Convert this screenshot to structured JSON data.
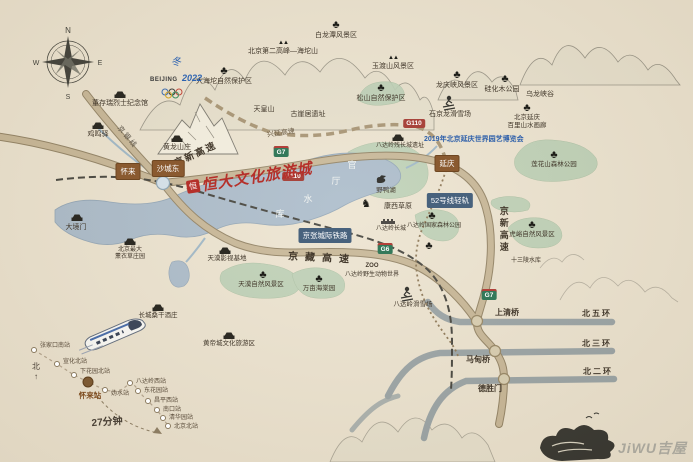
{
  "map": {
    "logo": {
      "seal": "恒",
      "text": "恒大文化旅游城"
    },
    "expo": "2019年北京延庆世界园艺博览会",
    "olympics": {
      "emblem": "冬",
      "name": "BEIJING",
      "year": "2022"
    },
    "compass": {
      "n": "N",
      "s": "S",
      "e": "E",
      "w": "W"
    },
    "trip_time": "27分钟",
    "north": "北",
    "north_arrow": "↑",
    "watermark": "JiWU吉屋",
    "colors": {
      "logo_red": "#b5302a",
      "expo_blue": "#2d5faa",
      "road_tan": "#c6b594",
      "ring_gray": "#97a1a3",
      "lake_blue": "#a9bac9",
      "green": "#b9ceb3",
      "town_brown": "#8a5a30"
    },
    "towns": [
      {
        "t": "怀来",
        "x": 128,
        "y": 163
      },
      {
        "t": "沙城东",
        "x": 168,
        "y": 160
      },
      {
        "t": "延庆",
        "x": 447,
        "y": 155
      }
    ],
    "signs": [
      {
        "t": "G7",
        "x": 281,
        "y": 146,
        "k": "exp"
      },
      {
        "t": "G110",
        "x": 293,
        "y": 172,
        "k": "nat"
      },
      {
        "t": "G110",
        "x": 414,
        "y": 119,
        "k": "nat"
      },
      {
        "t": "G6",
        "x": 385,
        "y": 243,
        "k": "exp"
      },
      {
        "t": "G7",
        "x": 489,
        "y": 289,
        "k": "exp"
      }
    ],
    "rail_labels": [
      {
        "t": "京张城际铁路",
        "x": 325,
        "y": 228
      },
      {
        "t": "52号线轻轨",
        "x": 450,
        "y": 193
      }
    ],
    "labels": [
      {
        "t": "董存瑞烈士纪念馆",
        "x": 120,
        "y": 100
      },
      {
        "t": "鸡鸣驿",
        "x": 98,
        "y": 131
      },
      {
        "t": "黄龙山庄",
        "x": 177,
        "y": 144
      },
      {
        "t": "大海坨自然保护区",
        "x": 224,
        "y": 78
      },
      {
        "t": "北京第二高峰—海坨山",
        "x": 283,
        "y": 48
      },
      {
        "t": "白龙潭风景区",
        "x": 336,
        "y": 32
      },
      {
        "t": "玉渡山风景区",
        "x": 393,
        "y": 63
      },
      {
        "t": "松山自然保护区",
        "x": 381,
        "y": 95
      },
      {
        "t": "天皇山",
        "x": 264,
        "y": 106
      },
      {
        "t": "古崖居遗址",
        "x": 308,
        "y": 111
      },
      {
        "t": "龙庆峡风景区",
        "x": 457,
        "y": 82
      },
      {
        "t": "石京龙滑雪场",
        "x": 450,
        "y": 111
      },
      {
        "t": "硅化木公园",
        "x": 502,
        "y": 86
      },
      {
        "t": "乌龙峡谷",
        "x": 540,
        "y": 91
      },
      {
        "t": "北京延庆",
        "x": 527,
        "y": 115,
        "s": 6.5
      },
      {
        "t": "百里山水画廊",
        "x": 527,
        "y": 123,
        "s": 6.5
      },
      {
        "t": "兴延高速",
        "x": 281,
        "y": 130,
        "r": -8,
        "c": "#6a5a43"
      },
      {
        "t": "莲花山森林公园",
        "x": 554,
        "y": 162,
        "s": 6.5
      },
      {
        "t": "虎峪自然风景区",
        "x": 532,
        "y": 232,
        "s": 6.5
      },
      {
        "t": "十三陵水库",
        "x": 526,
        "y": 258,
        "s": 6
      },
      {
        "t": "野鸭湖",
        "x": 386,
        "y": 188,
        "s": 6.5
      },
      {
        "t": "康西草原",
        "x": 398,
        "y": 203
      },
      {
        "t": "八达岭残长城遗址",
        "x": 400,
        "y": 143,
        "s": 6
      },
      {
        "t": "八达岭长城",
        "x": 391,
        "y": 226,
        "s": 6
      },
      {
        "t": "八达岭国家森林公园",
        "x": 434,
        "y": 223,
        "s": 6
      },
      {
        "t": "ZOO",
        "x": 372,
        "y": 263,
        "s": 6,
        "b": 1
      },
      {
        "t": "八达岭野生动物世界",
        "x": 372,
        "y": 272,
        "s": 6
      },
      {
        "t": "八达岭滑雪场",
        "x": 413,
        "y": 302,
        "s": 6.5
      },
      {
        "t": "天漠影视基地",
        "x": 227,
        "y": 256,
        "s": 6.5
      },
      {
        "t": "天漠自然风景区",
        "x": 261,
        "y": 282,
        "s": 6.5
      },
      {
        "t": "万亩海棠园",
        "x": 319,
        "y": 286,
        "s": 6.5
      },
      {
        "t": "北京最大",
        "x": 130,
        "y": 247,
        "s": 6
      },
      {
        "t": "薰衣草庄园",
        "x": 130,
        "y": 254,
        "s": 6
      },
      {
        "t": "大境门",
        "x": 76,
        "y": 224
      },
      {
        "t": "长城桑干酒庄",
        "x": 158,
        "y": 313,
        "s": 6.5
      },
      {
        "t": "黄帝城文化旅游区",
        "x": 229,
        "y": 341,
        "s": 6.5
      },
      {
        "t": "京新高速",
        "x": 196,
        "y": 150,
        "r": -25,
        "b": 1,
        "s": 9.5,
        "ls": 2
      },
      {
        "t": "京新高速",
        "x": 503,
        "y": 206,
        "v": 1,
        "b": 1,
        "s": 9,
        "ls": 3
      },
      {
        "t": "京藏高速",
        "x": 322,
        "y": 254,
        "r": 3,
        "b": 1,
        "s": 10,
        "ls": 7
      },
      {
        "t": "京银线",
        "x": 127,
        "y": 134,
        "r": 50,
        "s": 7,
        "c": "#5d5548",
        "ls": 2
      },
      {
        "t": "北五环",
        "x": 597,
        "y": 310,
        "s": 8,
        "b": 1,
        "ls": 2
      },
      {
        "t": "北三环",
        "x": 597,
        "y": 340,
        "s": 8,
        "b": 1,
        "ls": 2
      },
      {
        "t": "北二环",
        "x": 598,
        "y": 368,
        "s": 8,
        "b": 1,
        "ls": 2
      },
      {
        "t": "上清桥",
        "x": 507,
        "y": 309,
        "s": 8,
        "b": 1
      },
      {
        "t": "马甸桥",
        "x": 478,
        "y": 356,
        "s": 8,
        "b": 1
      },
      {
        "t": "德胜门",
        "x": 490,
        "y": 385,
        "s": 8,
        "b": 1
      }
    ],
    "lake_name_chars": [
      {
        "t": "官",
        "x": 352,
        "y": 158
      },
      {
        "t": "厅",
        "x": 336,
        "y": 174
      },
      {
        "t": "水",
        "x": 308,
        "y": 192
      },
      {
        "t": "库",
        "x": 280,
        "y": 207
      }
    ],
    "icons": [
      {
        "k": "tree",
        "x": 224,
        "y": 66
      },
      {
        "k": "tree",
        "x": 336,
        "y": 20
      },
      {
        "k": "tree",
        "x": 381,
        "y": 83
      },
      {
        "k": "tree",
        "x": 457,
        "y": 70
      },
      {
        "k": "tree",
        "x": 505,
        "y": 74
      },
      {
        "k": "tree",
        "x": 527,
        "y": 103
      },
      {
        "k": "tree",
        "x": 432,
        "y": 211
      },
      {
        "k": "tree",
        "x": 554,
        "y": 150
      },
      {
        "k": "tree",
        "x": 532,
        "y": 220
      },
      {
        "k": "tree",
        "x": 263,
        "y": 270
      },
      {
        "k": "tree",
        "x": 319,
        "y": 274
      },
      {
        "k": "tree",
        "x": 429,
        "y": 241
      },
      {
        "k": "mounts",
        "x": 283,
        "y": 40
      },
      {
        "k": "mounts",
        "x": 393,
        "y": 55
      },
      {
        "k": "horse",
        "x": 366,
        "y": 199
      },
      {
        "k": "bldg",
        "x": 120,
        "y": 91
      },
      {
        "k": "bldg",
        "x": 98,
        "y": 122
      },
      {
        "k": "bldg",
        "x": 177,
        "y": 135
      },
      {
        "k": "bldg",
        "x": 77,
        "y": 214
      },
      {
        "k": "bldg",
        "x": 130,
        "y": 238
      },
      {
        "k": "bldg",
        "x": 225,
        "y": 247
      },
      {
        "k": "bldg",
        "x": 158,
        "y": 304
      },
      {
        "k": "bldg",
        "x": 229,
        "y": 332
      },
      {
        "k": "bldg",
        "x": 398,
        "y": 134
      }
    ],
    "inset": {
      "stations": [
        {
          "t": "张家口南站",
          "dx": 34,
          "dy": 350,
          "lx": 40,
          "ly": 343
        },
        {
          "t": "宣化北站",
          "dx": 57,
          "dy": 364,
          "lx": 63,
          "ly": 359
        },
        {
          "t": "下花园北站",
          "dx": 74,
          "dy": 375,
          "lx": 80,
          "ly": 369
        },
        {
          "t": "怀来站",
          "dx": 88,
          "dy": 382,
          "lx": 90,
          "ly": 392,
          "major": 1
        },
        {
          "t": "妫水站",
          "dx": 105,
          "dy": 390,
          "lx": 111,
          "ly": 391
        },
        {
          "t": "八达岭西站",
          "dx": 130,
          "dy": 383,
          "lx": 136,
          "ly": 379
        },
        {
          "t": "东花园站",
          "dx": 138,
          "dy": 391,
          "lx": 144,
          "ly": 388
        },
        {
          "t": "昌平西站",
          "dx": 148,
          "dy": 401,
          "lx": 154,
          "ly": 398
        },
        {
          "t": "南口站",
          "dx": 157,
          "dy": 410,
          "lx": 163,
          "ly": 407
        },
        {
          "t": "清华园站",
          "dx": 163,
          "dy": 418,
          "lx": 169,
          "ly": 415
        },
        {
          "t": "北京北站",
          "dx": 168,
          "dy": 426,
          "lx": 174,
          "ly": 424
        }
      ]
    }
  }
}
